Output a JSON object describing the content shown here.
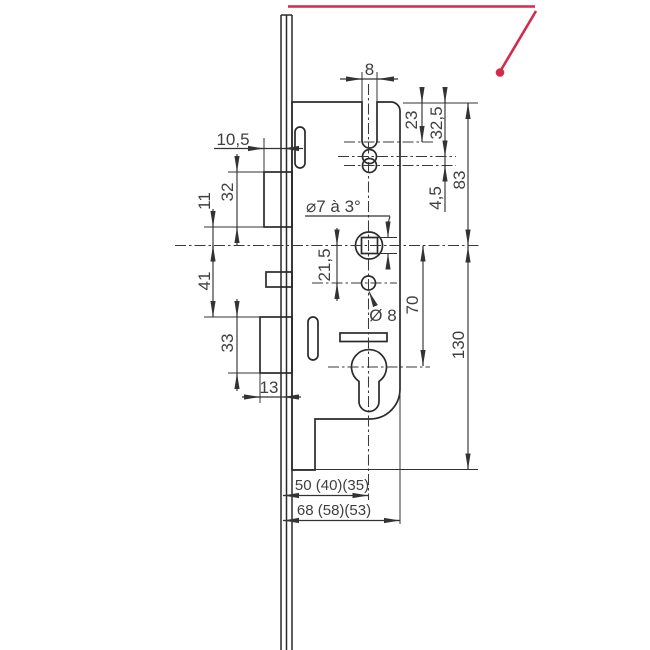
{
  "meta": {
    "kind": "lock-case technical drawing"
  },
  "colors": {
    "accent_red": "#d5294b",
    "line": "#2a2a2a",
    "text": "#3f3f3f"
  },
  "dims": {
    "slot_width": "8",
    "latch_protrusion": "10,5",
    "latch_height": "32",
    "latch_to_axis": "11",
    "axis_to_bolt": "41",
    "bolt_height": "33",
    "bolt_throw": "13",
    "top_to_slot": "23",
    "top_to_hole": "32,5",
    "hole_gap": "4,5",
    "top_to_axis": "83",
    "axis_to_hole8": "21,5",
    "axis_to_cylinder": "70",
    "axis_to_bottom": "130",
    "backset": "50 (40)(35)",
    "case_depth": "68 (58)(53)"
  },
  "notes": {
    "follower": "⌀7 à 3°",
    "hole8": "Ø 8"
  }
}
